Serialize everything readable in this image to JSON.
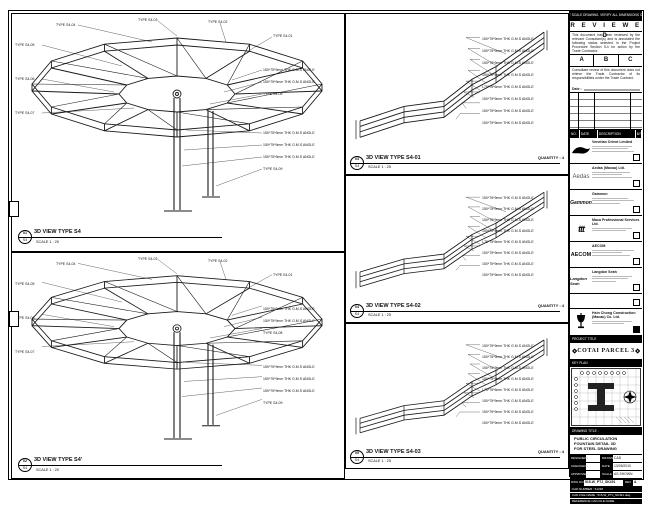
{
  "colors": {
    "ink": "#111111",
    "paper": "#ffffff",
    "muted_gray": "#bbbbbb"
  },
  "top_note": "DO NOT SCALE DRAWING. VERIFY ALL DIMENSIONS ON SITE.",
  "stamp": {
    "title": "R E V I E W E D",
    "para1": "This document has been reviewed by the relevant Consultant(s) and is annotated the following status selected in the Project Procedure Section 5.4 for action by the Trade Contractor.",
    "options": [
      "A",
      "B",
      "C"
    ],
    "para2": "Consultant review of this document does not relieve the Trade Contractor of its responsibilities under the Trade Contract.",
    "date_label": "Date :"
  },
  "revisions": {
    "headers": [
      "NO.",
      "DATE",
      "DESCRIPTION",
      "BY"
    ]
  },
  "consultants": [
    {
      "name": "Venetian Orient Limited",
      "logo": "venetian-logo"
    },
    {
      "name": "Aedas (Macau) Ltd.",
      "logo_text": "Aedas"
    },
    {
      "name": "Gammon",
      "logo_text": "Gammon"
    },
    {
      "name": "Maca Professional Services Ltd.",
      "logo_text": "ttt"
    },
    {
      "name": "AECOM",
      "logo_text": "AECOM"
    },
    {
      "name": "Langdon Seah",
      "logo_text": "Langdon Seah"
    }
  ],
  "contractor": {
    "name": "Hsin Chong Construction (Macau) Co. Ltd."
  },
  "project": {
    "label": "PROJECT TITLE",
    "name": "COTAI PARCEL 3"
  },
  "key_plan": {
    "label": "KEY PLAN"
  },
  "title_block": {
    "drawing_title_label": "DRAWING TITLE :",
    "title_lines": [
      "PUBLIC CIRCULATION",
      "FOUNTAIN DETAIL 3D",
      "FOR STEEL DRAWING"
    ],
    "fields": [
      {
        "l1": "DESIGNED",
        "v1": "-",
        "l2": "DRAWN",
        "v2": "CAD"
      },
      {
        "l1": "CHECKED",
        "v1": "-",
        "l2": "DATE",
        "v2": "13/05/2010"
      },
      {
        "l1": "APPROVED",
        "v1": "-",
        "l2": "SCALE",
        "v2": "AS SHOWN"
      }
    ],
    "dwg_no_label": "DWG NO :",
    "dwg_no": "515-W_PTJ_SK491",
    "rev_label": "REV",
    "rev": "A",
    "cad_rows": [
      "CAD NUMBER : 51238",
      "CAD FILE NAME : 515-W_PTJ_SK491.dwg",
      "REFERENCE CAD FILE NAME"
    ]
  },
  "panels": {
    "s4": {
      "title": "3D VIEW TYPE S4",
      "scale": "SCALE 1 : 20",
      "callout_top": "01",
      "callout_bottom": "S4",
      "labels": [
        "TYPE S4-05",
        "TYPE S4-04",
        "TYPE S4-03",
        "TYPE S4-02",
        "TYPE S4-01",
        "TYPE S4-06",
        "TYPE S4-07",
        "150*75*9mm THK G.M.S ANGLE",
        "150*75*9mm THK G.M.S ANGLE",
        "TYPE S4-08",
        "150*75*9mm THK G.M.S ANGLE",
        "150*75*9mm THK G.M.S ANGLE",
        "150*75*9mm THK G.M.S ANGLE",
        "TYPE S4-09"
      ]
    },
    "s4b": {
      "title": "3D VIEW TYPE S4'",
      "scale": "SCALE 1 : 20",
      "callout_top": "02",
      "callout_bottom": "S4",
      "labels": [
        "TYPE S4-05",
        "TYPE S4-04",
        "TYPE S4-03",
        "TYPE S4-02",
        "TYPE S4-01",
        "TYPE S4-06",
        "TYPE S4-07",
        "150*75*9mm THK G.M.S ANGLE",
        "150*75*9mm THK G.M.S ANGLE",
        "TYPE S4-08",
        "150*75*9mm THK G.M.S ANGLE",
        "150*75*9mm THK G.M.S ANGLE",
        "150*75*9mm THK G.M.S ANGLE",
        "TYPE S4-09"
      ]
    },
    "s401": {
      "title": "3D VIEW TYPE S4-01",
      "scale": "SCALE 1 : 25",
      "quantity": "QUANTITY : 4",
      "callout_top": "03",
      "callout_bottom": "S4",
      "labels": [
        "150*75*9mm THK G.M.S ANGLE",
        "150*75*9mm THK G.M.S ANGLE",
        "150*75*9mm THK G.M.S ANGLE",
        "150*75*9mm THK G.M.S ANGLE",
        "L75*75*6mm THK G.M.S ANGLE",
        "150*75*9mm THK G.M.S ANGLE",
        "150*75*9mm THK G.M.S ANGLE",
        "150*75*9mm THK G.M.S ANGLE"
      ]
    },
    "s402": {
      "title": "3D VIEW TYPE S4-02",
      "scale": "SCALE 1 : 25",
      "quantity": "QUANTITY : 4",
      "callout_top": "04",
      "callout_bottom": "S4",
      "labels": [
        "150*75*9mm THK G.M.S ANGLE",
        "150*75*9mm THK G.M.S ANGLE",
        "150*75*9mm THK G.M.S ANGLE",
        "150*75*9mm THK G.M.S ANGLE",
        "L75*75*6mm THK G.M.S ANGLE",
        "150*75*9mm THK G.M.S ANGLE",
        "150*75*9mm THK G.M.S ANGLE",
        "150*75*9mm THK G.M.S ANGLE"
      ]
    },
    "s403": {
      "title": "3D VIEW TYPE S4-03",
      "scale": "SCALE 1 : 25",
      "quantity": "QUANTITY : 4",
      "callout_top": "05",
      "callout_bottom": "S4",
      "labels": [
        "150*75*9mm THK G.M.S ANGLE",
        "150*75*9mm THK G.M.S ANGLE",
        "150*75*9mm THK G.M.S ANGLE",
        "150*75*9mm THK G.M.S ANGLE",
        "L75*75*6mm THK G.M.S ANGLE",
        "150*75*9mm THK G.M.S ANGLE",
        "150*75*9mm THK G.M.S ANGLE",
        "150*75*9mm THK G.M.S ANGLE"
      ]
    }
  }
}
